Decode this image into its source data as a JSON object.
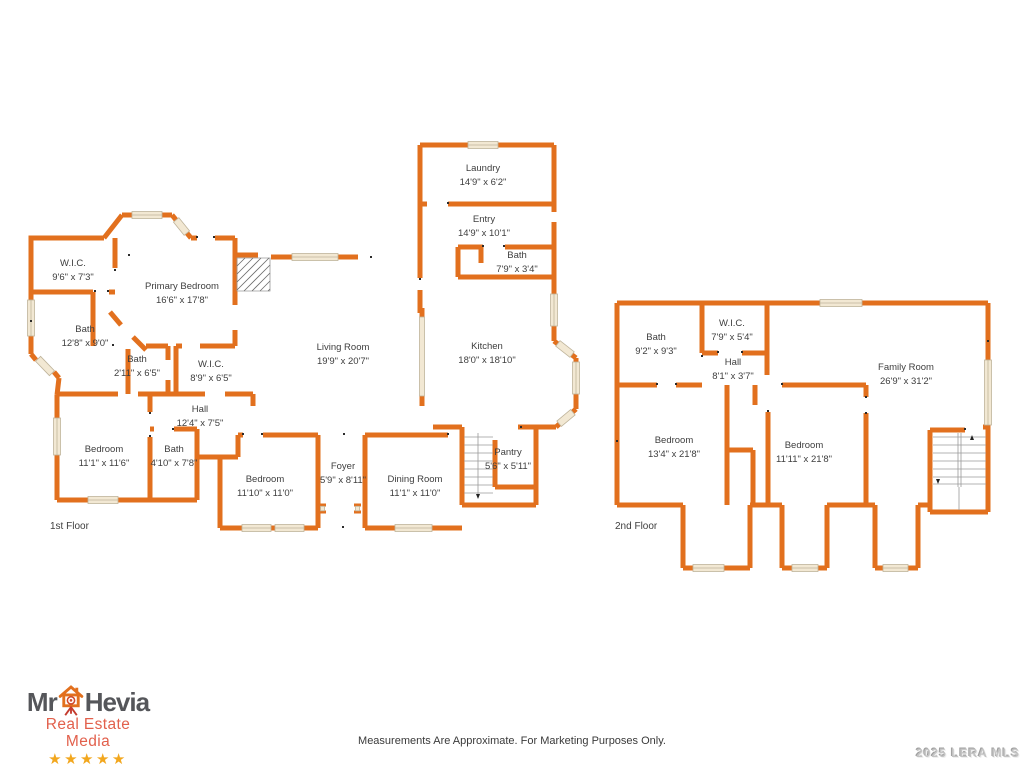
{
  "colors": {
    "wall": "#E2701E",
    "label_text": "#3E3E3E",
    "window_fill": "#F2E8D3",
    "logo_gray": "#55565A",
    "logo_red": "#E2604C",
    "star_gold": "#F2A71E",
    "watermark_gray": "#C3C3C3"
  },
  "floor1": {
    "label": "1st Floor",
    "rooms": [
      {
        "name": "W.I.C.",
        "dims": "9'6\" x 7'3\""
      },
      {
        "name": "Primary Bedroom",
        "dims": "16'6\" x 17'8\""
      },
      {
        "name": "Bath",
        "dims": "12'8\" x 9'0\""
      },
      {
        "name": "Bath",
        "dims": "2'11\" x 6'5\""
      },
      {
        "name": "W.I.C.",
        "dims": "8'9\" x 6'5\""
      },
      {
        "name": "Hall",
        "dims": "12'4\" x 7'5\""
      },
      {
        "name": "Bedroom",
        "dims": "11'1\" x 11'6\""
      },
      {
        "name": "Bath",
        "dims": "4'10\" x 7'8\""
      },
      {
        "name": "Bedroom",
        "dims": "11'10\" x 11'0\""
      },
      {
        "name": "Foyer",
        "dims": "5'9\" x 8'11\""
      },
      {
        "name": "Dining Room",
        "dims": "11'1\" x 11'0\""
      },
      {
        "name": "Living Room",
        "dims": "19'9\" x 20'7\""
      },
      {
        "name": "Kitchen",
        "dims": "18'0\" x 18'10\""
      },
      {
        "name": "Laundry",
        "dims": "14'9\" x 6'2\""
      },
      {
        "name": "Entry",
        "dims": "14'9\" x 10'1\""
      },
      {
        "name": "Bath",
        "dims": "7'9\" x 3'4\""
      },
      {
        "name": "Pantry",
        "dims": "5'6\" x 5'11\""
      }
    ]
  },
  "floor2": {
    "label": "2nd Floor",
    "rooms": [
      {
        "name": "Bath",
        "dims": "9'2\" x 9'3\""
      },
      {
        "name": "W.I.C.",
        "dims": "7'9\" x 5'4\""
      },
      {
        "name": "Hall",
        "dims": "8'1\" x 3'7\""
      },
      {
        "name": "Family Room",
        "dims": "26'9\" x 31'2\""
      },
      {
        "name": "Bedroom",
        "dims": "13'4\" x 21'8\""
      },
      {
        "name": "Bedroom",
        "dims": "11'11\" x 21'8\""
      }
    ]
  },
  "logo": {
    "word1": "Mr",
    "word2": "Hevia",
    "tagline": "Real Estate Media",
    "stars": "★★★★★"
  },
  "footer": {
    "disclaimer": "Measurements Are Approximate. For Marketing Purposes Only.",
    "watermark": "2025 LERA MLS"
  }
}
